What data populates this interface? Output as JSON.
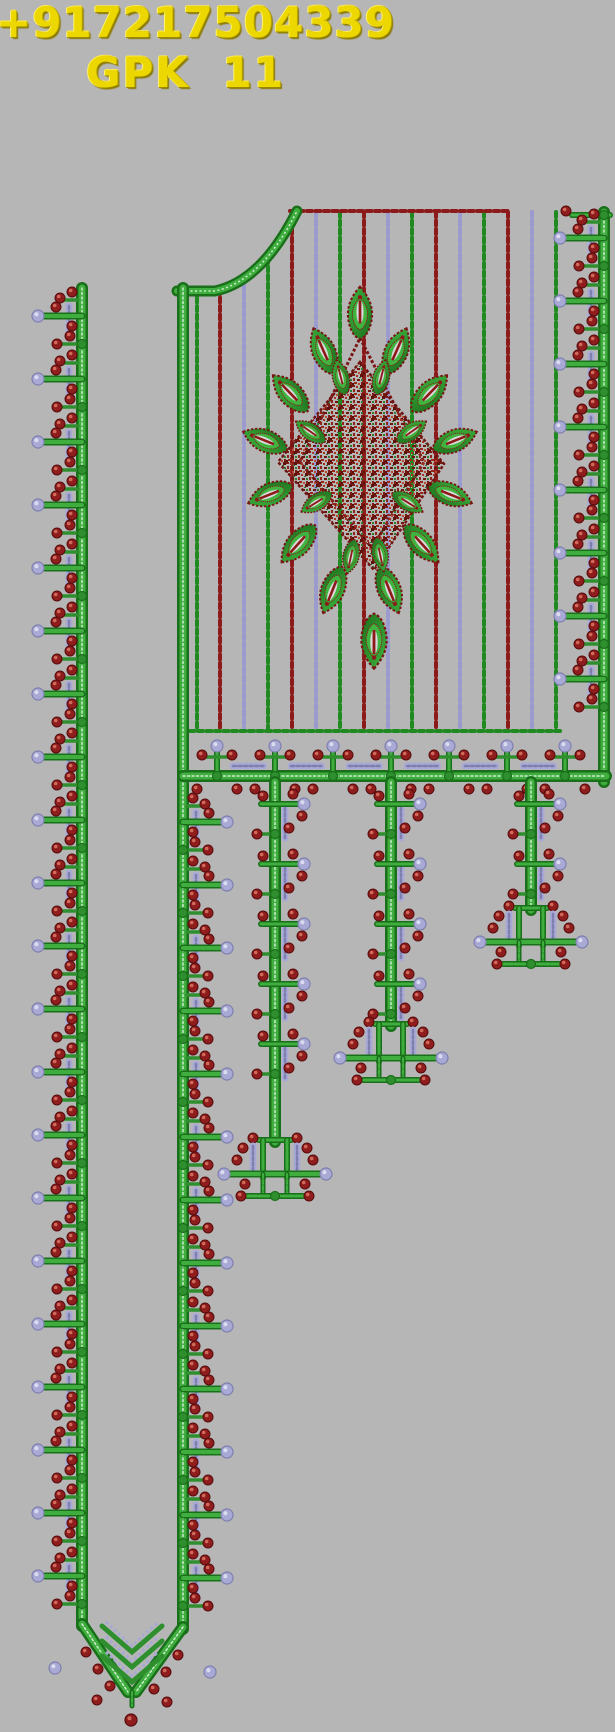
{
  "header": {
    "phone": "+917217504339",
    "brand": "GPK 11",
    "text_color": "#ecd700"
  },
  "palette": {
    "background": "#b6b6b6",
    "stripe_green": "#1f8a1f",
    "stripe_red": "#8c1a1a",
    "stripe_lavender": "#9a9ace",
    "green_dark": "#1a701a",
    "green_mid": "#3fae3f",
    "green_light": "#cfeccf",
    "green_node": "#2f8f2f",
    "berry_red": "#8f1d1d",
    "berry_red_dark": "#570d0d",
    "berry_red_hi": "#cf6a5a",
    "lavender": "#a9a9d6",
    "lavender_dark": "#7f7fae",
    "lavender_hi": "#dcdcf0",
    "outline_maroon": "#7a1616",
    "leaf_green_light": "#3fb43f",
    "leaf_green_dark": "#1c6e1c",
    "slit_white": "#d9d9d9"
  },
  "design": {
    "width": 615,
    "height": 1732,
    "stripes": [
      {
        "x": 197,
        "c": "G",
        "y1": 289
      },
      {
        "x": 220,
        "c": "R",
        "y1": 289
      },
      {
        "x": 244,
        "c": "L",
        "y1": 277
      },
      {
        "x": 268,
        "c": "G",
        "y1": 258
      },
      {
        "x": 292,
        "c": "R",
        "y1": 212
      },
      {
        "x": 316,
        "c": "L",
        "y1": 212
      },
      {
        "x": 340,
        "c": "G",
        "y1": 212
      },
      {
        "x": 364,
        "c": "R",
        "y1": 212
      },
      {
        "x": 388,
        "c": "L",
        "y1": 212
      },
      {
        "x": 412,
        "c": "G",
        "y1": 212
      },
      {
        "x": 436,
        "c": "R",
        "y1": 212
      },
      {
        "x": 460,
        "c": "L",
        "y1": 212
      },
      {
        "x": 484,
        "c": "G",
        "y1": 212
      },
      {
        "x": 508,
        "c": "R",
        "y1": 212
      },
      {
        "x": 532,
        "c": "L",
        "y1": 212
      },
      {
        "x": 556,
        "c": "G",
        "y1": 212
      }
    ],
    "stripe_y2": 728,
    "panel": {
      "top_line": {
        "y": 211,
        "x1": 290,
        "x2": 510,
        "c": "R"
      },
      "bottom_line": {
        "y": 731,
        "x1": 181,
        "x2": 560,
        "c": "G"
      },
      "neck_curve": "M177,291 L215,291 Q262,281 297,211"
    },
    "right_border": {
      "stem_x": 604,
      "y1": 212,
      "y2": 782,
      "unit": 63,
      "unit_start": 214,
      "unit_end": 718,
      "dir": -1,
      "cap_bar": {
        "x1": 572,
        "x2": 610,
        "y": 215
      },
      "cap_berry": {
        "x": 566,
        "y": 211
      }
    },
    "left_border": {
      "stem_x": 82,
      "y1": 288,
      "y2": 1626,
      "unit": 63,
      "unit_start": 292,
      "unit_end": 1554,
      "dir": -1
    },
    "inner_strip": {
      "stem_x": 183,
      "y1": 288,
      "y2": 1629,
      "unit": 63,
      "unit_start": 798,
      "unit_end": 1558,
      "dir": 1
    },
    "band": {
      "y": 776,
      "x1": 183,
      "x2": 606,
      "stems": [
        217,
        275,
        333,
        391,
        449,
        507,
        565
      ]
    },
    "tassels": [
      {
        "x": 275,
        "top": 782,
        "anchor_y": 1138,
        "unit": 60,
        "unit_start": 792
      },
      {
        "x": 391,
        "top": 782,
        "anchor_y": 1022,
        "unit": 60,
        "unit_start": 792
      },
      {
        "x": 531,
        "top": 782,
        "anchor_y": 906,
        "unit": 60,
        "unit_start": 792
      }
    ],
    "vpoint": {
      "apex_x": 132,
      "apex_y": 1694,
      "outer_from": [
        82,
        1624
      ],
      "inner_from": [
        183,
        1627
      ],
      "final_berry": [
        131,
        1720
      ]
    },
    "motif": {
      "noise_path": "M360,362 L444,464 L374,570 L278,462 Z",
      "ring1": "M360,338 L424,462 L372,548 L300,462 Z",
      "leaves_outer": [
        [
          360,
          314,
          0,
          1.05
        ],
        [
          324,
          352,
          -24,
          1
        ],
        [
          396,
          352,
          24,
          1
        ],
        [
          291,
          394,
          -44,
          1
        ],
        [
          429,
          394,
          44,
          1
        ],
        [
          266,
          441,
          -68,
          0.95
        ],
        [
          454,
          441,
          68,
          0.95
        ],
        [
          271,
          494,
          -112,
          0.95
        ],
        [
          449,
          494,
          112,
          0.95
        ],
        [
          299,
          543,
          -138,
          1
        ],
        [
          421,
          543,
          138,
          1
        ],
        [
          333,
          589,
          -158,
          1
        ],
        [
          389,
          589,
          158,
          1
        ],
        [
          374,
          640,
          180,
          1.1
        ]
      ],
      "leaves_inner": [
        [
          341,
          378,
          -14,
          0.72
        ],
        [
          381,
          378,
          14,
          0.72
        ],
        [
          311,
          432,
          -55,
          0.72
        ],
        [
          411,
          432,
          55,
          0.72
        ],
        [
          317,
          502,
          -122,
          0.72
        ],
        [
          407,
          502,
          122,
          0.72
        ],
        [
          351,
          556,
          -168,
          0.7
        ],
        [
          380,
          554,
          168,
          0.7
        ]
      ]
    }
  }
}
